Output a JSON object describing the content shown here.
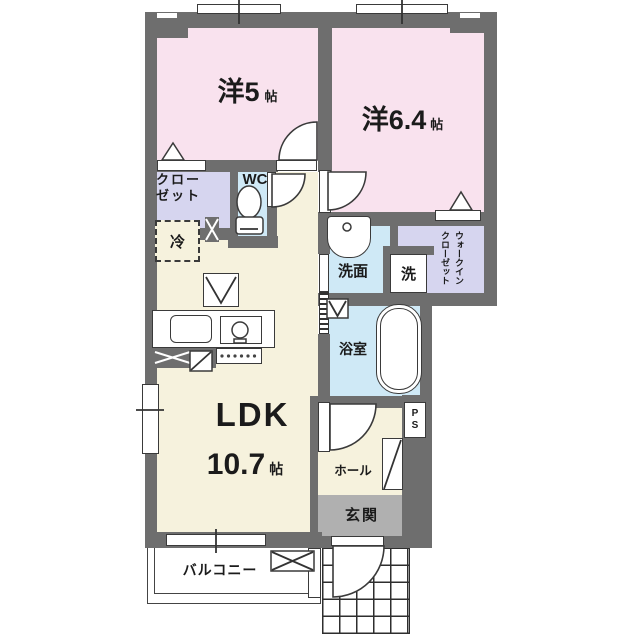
{
  "rooms": {
    "room5": {
      "label": "洋5",
      "unit": "帖"
    },
    "room64": {
      "label": "洋6.4",
      "unit": "帖"
    },
    "closet": {
      "line1": "クロー",
      "line2": "ゼット"
    },
    "wc": {
      "label": "WC"
    },
    "fridge": {
      "label": "冷"
    },
    "washroom": {
      "label": "洗面"
    },
    "washer": {
      "label": "洗"
    },
    "walkin": {
      "line1": "ウォークイン",
      "line2": "クローゼット"
    },
    "bathroom": {
      "label": "浴室"
    },
    "ldk": {
      "label": "LDK",
      "size": "10.7",
      "unit": "帖"
    },
    "hall": {
      "label": "ホール"
    },
    "entrance": {
      "label": "玄関"
    },
    "balcony": {
      "label": "バルコニー"
    },
    "ps": {
      "label": "PS"
    }
  },
  "colors": {
    "wall": "#6e6e6e",
    "room_pink": "#f9e2ee",
    "closet_lavender": "#d6d5ef",
    "wet_area_blue": "#cfe9f6",
    "living_cream": "#f6f2dd",
    "entrance_gray": "#b0b0b0"
  }
}
